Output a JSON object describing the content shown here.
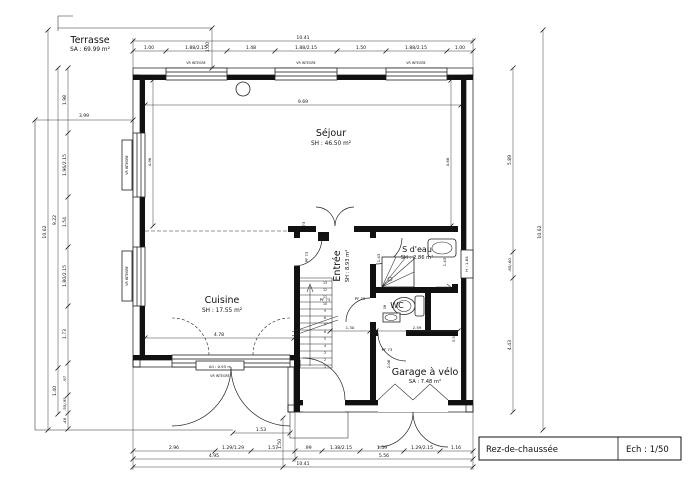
{
  "title_block": {
    "name": "Rez-de-chaussée",
    "scale": "Ech : 1/50"
  },
  "rooms": {
    "terrasse": {
      "name": "Terrasse",
      "area": "SA : 69.99 m²"
    },
    "sejour": {
      "name": "Séjour",
      "area": "SH : 46.50 m²"
    },
    "cuisine": {
      "name": "Cuisine",
      "area": "SH : 17.55 m²"
    },
    "entree": {
      "name": "Entrée",
      "area": "SH : 8.93 m²"
    },
    "sdeau": {
      "name": "S d'eau",
      "area": "SH : 2.86 m²"
    },
    "wc": {
      "name": "WC",
      "sh": "SH"
    },
    "garage": {
      "name": "Garage à vélo",
      "area": "SA : 7.48 m²"
    }
  },
  "labels": {
    "vr_integre": "VR INTEGRE",
    "pf73": "PF 73",
    "door_sill": "All : 0.95 m",
    "window_h": "H : 1.64"
  },
  "dims": {
    "top_total": "10.41",
    "top": [
      "1.00",
      "1.88/2.15",
      "1.48",
      "1.88/2.15",
      "1.50",
      "1.88/2.15",
      "1.00"
    ],
    "terrace_top": "1.00",
    "terrace_left": "3.99",
    "left_total": "10.62",
    "left_span": "9.22",
    "left_bottom": "1.40",
    "left": [
      "1.98",
      "1.96/2.15",
      "1.54",
      "1.80/2.15",
      "1.73",
      ".97",
      ".55/.95",
      ".48"
    ],
    "right_total": "10.62",
    "right": [
      "5.89",
      ".65/.60",
      "4.43"
    ],
    "bottom": [
      "2.96",
      "1.29/1.29",
      "1.57",
      ".99",
      "1.38/2.15",
      "1.59",
      "1.29/2.15",
      "1.16"
    ],
    "bottom_sub": [
      "4.95",
      "5.56"
    ],
    "bottom_total": "10.41",
    "porch_width": "1.53",
    "porch_depth": "1.50",
    "sejour_width": "9.69",
    "sejour_left": "4.96",
    "sejour_right": "4.66",
    "cuisine_width": "4.78",
    "hall": "1.30",
    "wc": "2.59",
    "shower_left": "1.43",
    "shower_right": "1.43",
    "garage_depth": "3.51",
    "garage_width": "2.06"
  },
  "stairs": {
    "numbers": [
      "1",
      "2",
      "3",
      "4",
      "5",
      "6",
      "7",
      "8",
      "9",
      "10",
      "11",
      "12",
      "13"
    ]
  }
}
